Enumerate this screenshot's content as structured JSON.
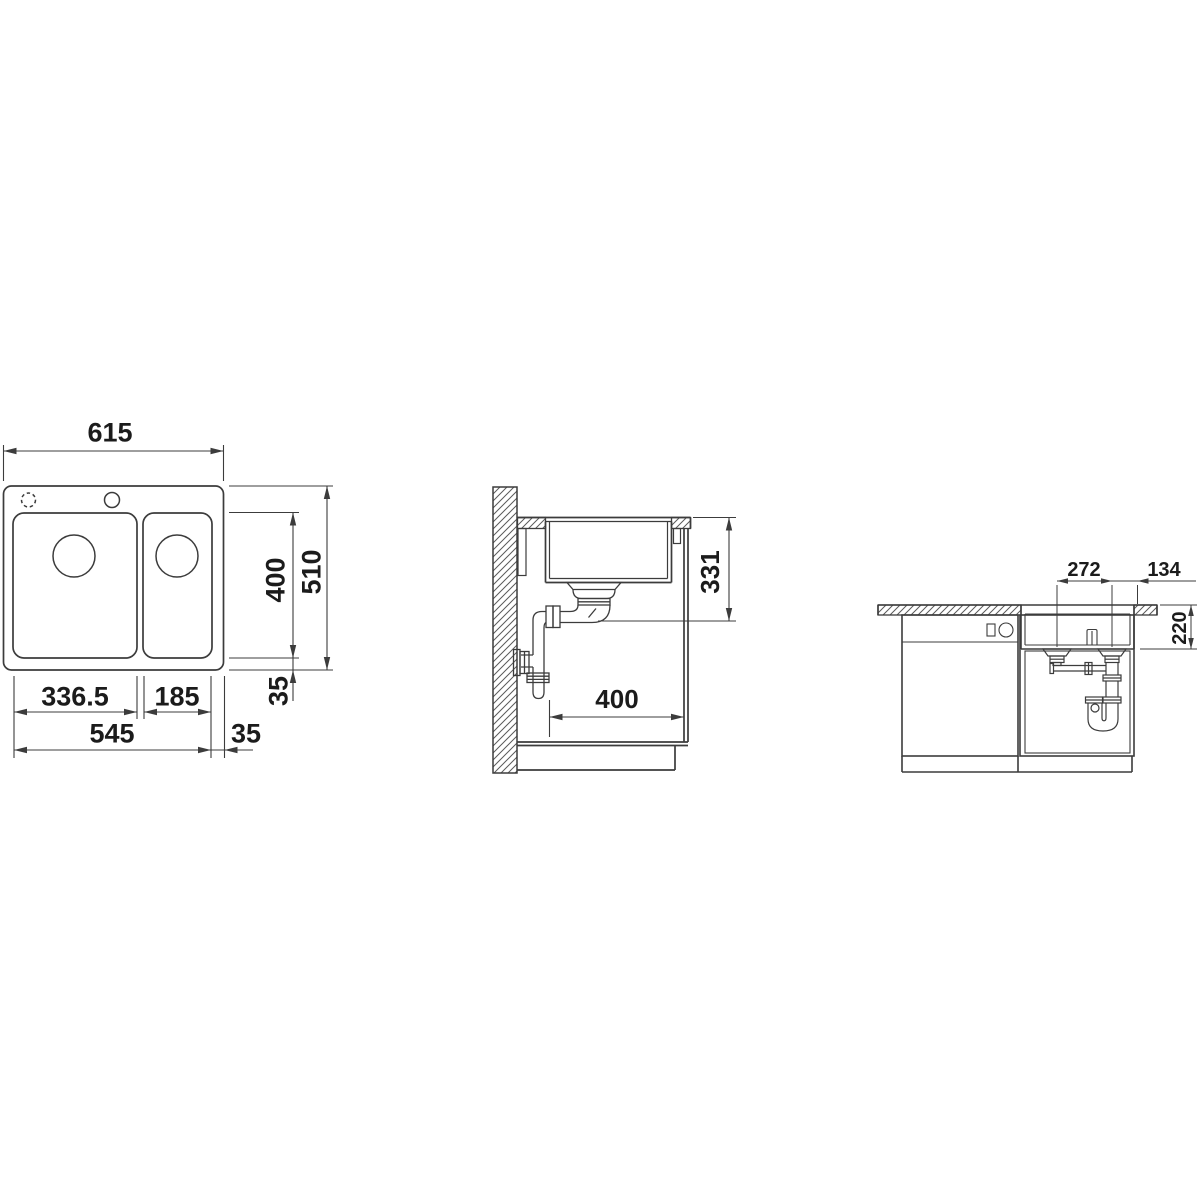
{
  "drawing": {
    "background": "#ffffff",
    "line_color": "#3c3c3c",
    "text_color": "#1b1b1b",
    "views": {
      "top_view": {
        "title": "sink-plan-view",
        "dims": {
          "overall_width": "615",
          "bowl_depth": "400",
          "overall_depth": "510",
          "rim_side": "35",
          "main_bowl_width": "336.5",
          "half_bowl_width": "185",
          "bowls_width": "545",
          "rim_bottom": "35"
        }
      },
      "side_view": {
        "title": "cabinet-side-section",
        "dims": {
          "outlet_depth": "331",
          "cabinet_clearance": "400"
        }
      },
      "front_view": {
        "title": "cabinet-front-view",
        "dims": {
          "drain_spacing": "272",
          "drain_to_edge": "134",
          "bowl_height": "220"
        }
      }
    }
  }
}
